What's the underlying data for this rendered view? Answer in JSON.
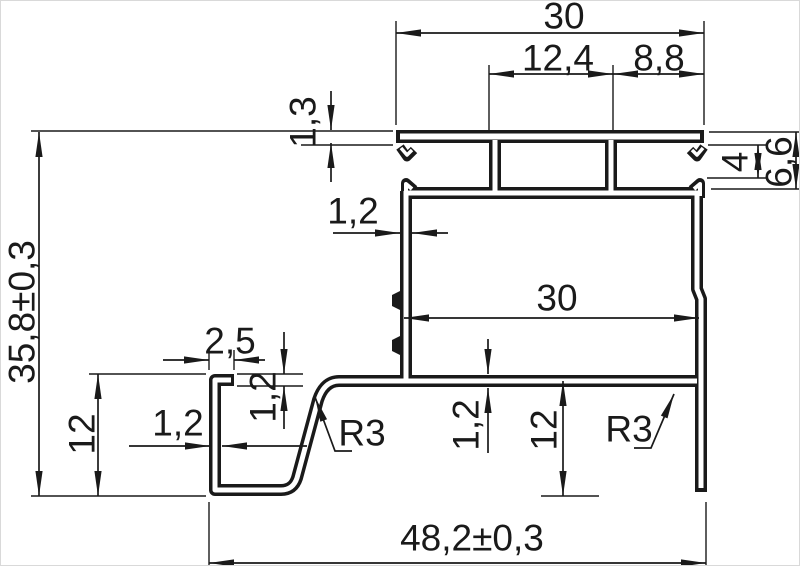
{
  "drawing": {
    "kind": "extruded-profile-cross-section",
    "dims": {
      "top_width": "30",
      "top_slot_span": "12,4",
      "top_right_span": "8,8",
      "plate_thickness": "1,3",
      "overall_height": "35,8±0,3",
      "upper_wall_thickness": "1,2",
      "inner_width": "30",
      "hook_total_depth": "6,6",
      "hook_opening": "4",
      "lip_width": "2,5",
      "lip_thickness": "1,2",
      "channel_wall_thickness": "1,2",
      "channel_depth": "12",
      "base_thickness": "1,2",
      "leg_height": "12",
      "left_fillet_radius": "R3",
      "right_fillet_radius": "R3",
      "overall_width": "48,2±0,3"
    },
    "style": {
      "line_color": "#1a1a1a",
      "background": "#ffffff",
      "border_color": "#d9d9d9"
    }
  }
}
